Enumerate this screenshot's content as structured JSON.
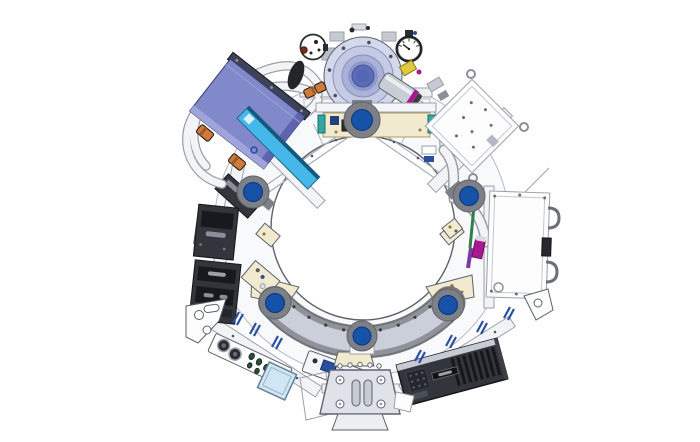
{
  "figure": {
    "type": "technical-illustration",
    "subject": "scanner-gantry-front-view",
    "background": "#ffffff",
    "mount_disc_count": 6
  },
  "colors": {
    "background": "#ffffff",
    "frame_fill": "#f8f9fb",
    "frame_line": "#bdc1c9",
    "bore_fill": "#ffffff",
    "bore_stroke": "#4d525b",
    "mount_ring": "#7d8187",
    "mount_blue": "#1652a8",
    "crescent_edge": "#6f7278",
    "crescent_band": "#8f9298",
    "crescent_inner": "#cacfd9",
    "pump_body": "#c5cbe4",
    "pump_ring": "#aab2d8",
    "pump_mid": "#8f98cc",
    "pump_core": "#5a6cb8",
    "purple_top": "#8289cb",
    "purple_side": "#5d63ad",
    "purple_rail": "#3e4258",
    "cyan_panel": "#45b7e8",
    "cream": "#f1eacf",
    "cream_edge": "#ab9c62",
    "dark_module": "#32353b",
    "dark_detail": "#17191d",
    "hose": "#f3f4f6",
    "hose_edge": "#9aa0aa",
    "fitting_orange": "#cf7a3a",
    "fitting_orange_dark": "#9e5a24",
    "magenta": "#a8188e",
    "yellow": "#ddc83e",
    "teal": "#2fa8a2",
    "navy": "#24407c",
    "pin_blue": "#2b4fa0",
    "panel_white": "#fdfdfe",
    "plate_blue": "#cfe6f4",
    "gauge_face": "#ffffff",
    "gauge_ring": "#1d1f23",
    "steel": "#c9cdd6",
    "rail_fill": "#f2f3f6"
  },
  "components": [
    "gantry-ring-frame",
    "bore-opening",
    "mount-discs",
    "crescent-guide-rail",
    "coolant-pump",
    "pressure-gauge",
    "shutoff-valve",
    "purple-component-box",
    "cyan-cover-panel",
    "coolant-hoses",
    "electronics-modules",
    "tilted-white-panel",
    "tall-white-panel",
    "connector-panel",
    "blue-window-plate",
    "connector-strip",
    "mounting-bracket",
    "finned-power-module",
    "corner-brackets"
  ]
}
